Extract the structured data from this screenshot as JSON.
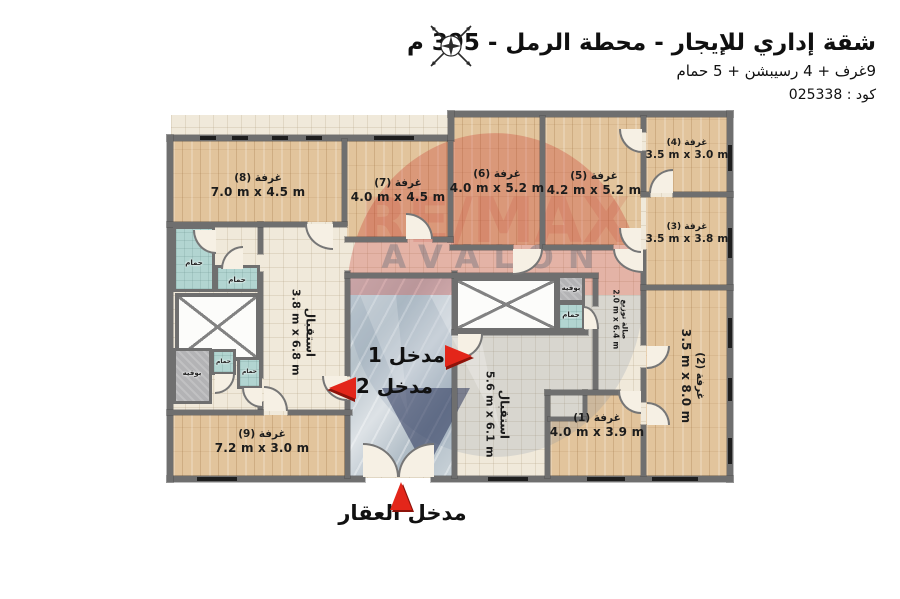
{
  "header": {
    "title": "شقة إداري للإيجار - محطة الرمل - 395 م",
    "summary": "9غرف + 4 رسيبشن + 5 حمام",
    "code": "كود : 025338"
  },
  "watermark": {
    "brand": "RE/MAX",
    "name": "AVALON"
  },
  "rooms": {
    "r1": {
      "name": "غرفة (1)",
      "dims": "4.0 m x 3.9 m"
    },
    "r2": {
      "name": "غرفة (2)",
      "dims": "3.5 m x 8.0 m"
    },
    "r3": {
      "name": "غرفة (3)",
      "dims": "3.5 m x 3.8 m"
    },
    "r4": {
      "name": "غرفة (4)",
      "dims": "3.5 m x 3.0 m"
    },
    "r5": {
      "name": "غرفة (5)",
      "dims": "4.2 m x 5.2 m"
    },
    "r6": {
      "name": "غرفة (6)",
      "dims": "4.0 m x 5.2 m"
    },
    "r7": {
      "name": "غرفة (7)",
      "dims": "4.0 m x 4.5 m"
    },
    "r8": {
      "name": "غرفة (8)",
      "dims": "7.0 m x 4.5 m"
    },
    "r9": {
      "name": "غرفة (9)",
      "dims": "7.2 m x 3.0 m"
    }
  },
  "halls": {
    "reception_left": {
      "name": "استقبال",
      "dims": "3.8 m x 6.8 m"
    },
    "reception_main": {
      "name": "استقبال",
      "dims": "5.6 m x 6.1 m"
    },
    "distribution": {
      "name": "صالة توزيع",
      "dims": "2.0 m x 6.4 m"
    }
  },
  "service": {
    "bathroom": "حمام",
    "buffet": "بوفيه"
  },
  "entrances": {
    "e1": "مدخل 1",
    "e2": "مدخل 2",
    "main": "مدخل العقار"
  },
  "colors": {
    "accent_red": "#d8281a",
    "wall_gray": "#6f6f6f",
    "wood": "#e2c49c",
    "tile": "#f0e9da",
    "marble": "#bec9d1",
    "bath_teal": "#b2d5d1",
    "buffet_gray": "#b3b3b5"
  }
}
